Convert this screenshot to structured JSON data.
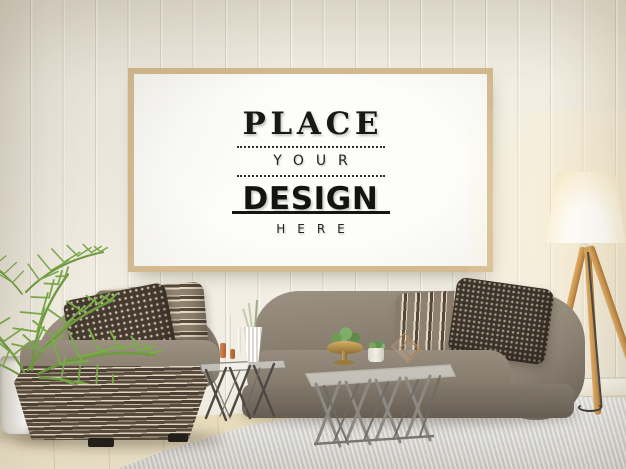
{
  "scene": {
    "description": "Interior living-room poster mockup: wooden frame on white paneled wall above taupe modular sofas, palm plant, wire tables, shag rug and tripod floor lamp",
    "poster": {
      "line1": "PLACE",
      "line2": "YOUR",
      "line3": "DESIGN",
      "line4": "HERE"
    },
    "palette": {
      "wall": "#f2eee3",
      "frame_wood": "#d4ba90",
      "poster_bg": "#fbfaf7",
      "ink": "#191815",
      "sofa_taupe": "#8a8072",
      "sofa_shadow": "#6b6257",
      "base_stripe_dark": "#564a3d",
      "base_stripe_cream": "#e3d8c2",
      "pillow_dark": "#463b30",
      "plant_green": "#79a24a",
      "lamp_wood": "#cd964e",
      "lamp_shade_glow": "#fffef9",
      "rug": "#e6e5e1",
      "floor_wood": "#ecdfbe",
      "table_metal": "#8e8b85"
    },
    "objects": [
      "poster-frame",
      "paneled-wall",
      "palm-plant",
      "white-planter",
      "chaise-sofa",
      "striped-ottoman-base",
      "diamond-pattern-pillow",
      "striped-pillow",
      "wire-side-table",
      "taper-candles",
      "ribbed-vase",
      "modular-sofa",
      "wire-coffee-table",
      "succulent-bowl",
      "tripod-floor-lamp",
      "shag-rug",
      "wood-floor"
    ]
  }
}
